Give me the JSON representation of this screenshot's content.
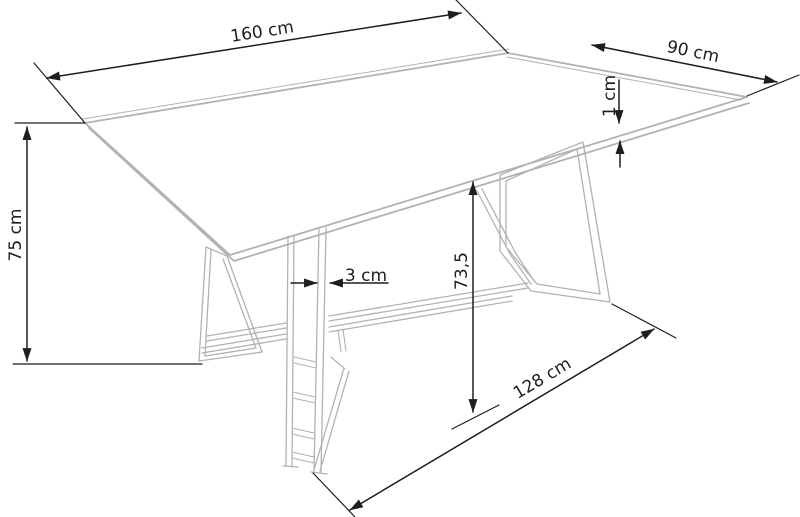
{
  "figure": {
    "type": "furniture-dimension-diagram",
    "subject": "rectangular dining table on two trapezoid metal frame legs with center stretcher, isometric line drawing with dimension annotations",
    "colors": {
      "background": "#ffffff",
      "product_outline": "#b2b2b2",
      "dimension_lines": "#1e1e1e",
      "label_text": "#1e1e1e"
    },
    "labels": {
      "top_length": "160 cm",
      "top_depth": "90 cm",
      "top_thickness": "1 cm",
      "total_height": "75 cm",
      "frame_tube_width": "3 cm",
      "underside_clearance": "73,5",
      "base_length": "128 cm"
    }
  }
}
